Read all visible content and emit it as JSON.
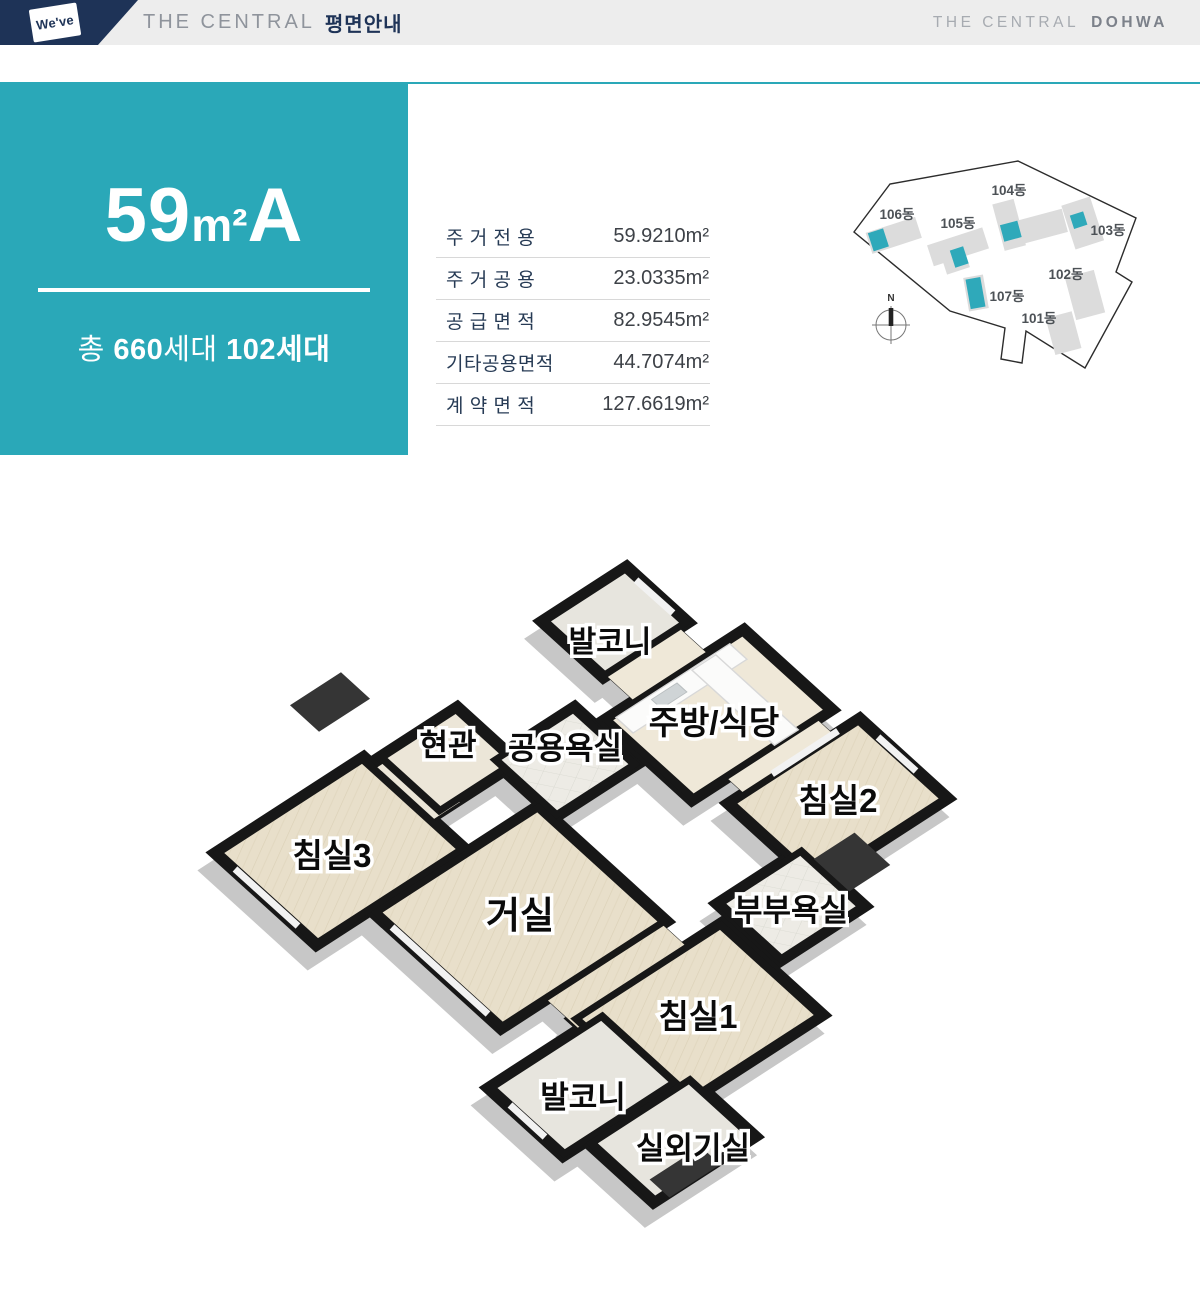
{
  "header": {
    "logo_text": "We've",
    "doc_title_en": "THE CENTRAL",
    "doc_title_ko": "평면안내",
    "brand_left": "THE CENTRAL",
    "brand_right": "DOHWA"
  },
  "unit_card": {
    "size_number": "59",
    "size_unit": "m²",
    "type_letter": "A",
    "households_prefix": "총",
    "households_total": "660",
    "households_total_suffix": "세대",
    "households_type": "102세대"
  },
  "area_table": {
    "rows": [
      {
        "label": "주 거 전 용",
        "value": "59.9210m²"
      },
      {
        "label": "주 거 공 용",
        "value": "23.0335m²"
      },
      {
        "label": "공 급 면 적",
        "value": "82.9545m²"
      },
      {
        "label": "기타공용면적",
        "value": "44.7074m²"
      },
      {
        "label": "계 약 면 적",
        "value": "127.6619m²"
      }
    ]
  },
  "site_plan": {
    "compass_label": "N",
    "buildings": [
      {
        "label": "106동",
        "highlighted": true
      },
      {
        "label": "105동",
        "highlighted": true
      },
      {
        "label": "104동",
        "highlighted": true
      },
      {
        "label": "103동",
        "highlighted": true
      },
      {
        "label": "102동",
        "highlighted": false
      },
      {
        "label": "107동",
        "highlighted": true
      },
      {
        "label": "101동",
        "highlighted": false
      }
    ]
  },
  "floor_plan": {
    "rooms": [
      {
        "label": "발코니"
      },
      {
        "label": "현관"
      },
      {
        "label": "공용욕실"
      },
      {
        "label": "주방/식당"
      },
      {
        "label": "침실2"
      },
      {
        "label": "침실3"
      },
      {
        "label": "거실"
      },
      {
        "label": "부부욕실"
      },
      {
        "label": "침실1"
      },
      {
        "label": "발코니"
      },
      {
        "label": "실외기실"
      }
    ]
  },
  "colors": {
    "teal": "#2aa8b8",
    "navy": "#1e3357",
    "wall_black": "#171717",
    "floor_beige": "#e8dfca",
    "site_highlight": "#2fa9ba"
  }
}
